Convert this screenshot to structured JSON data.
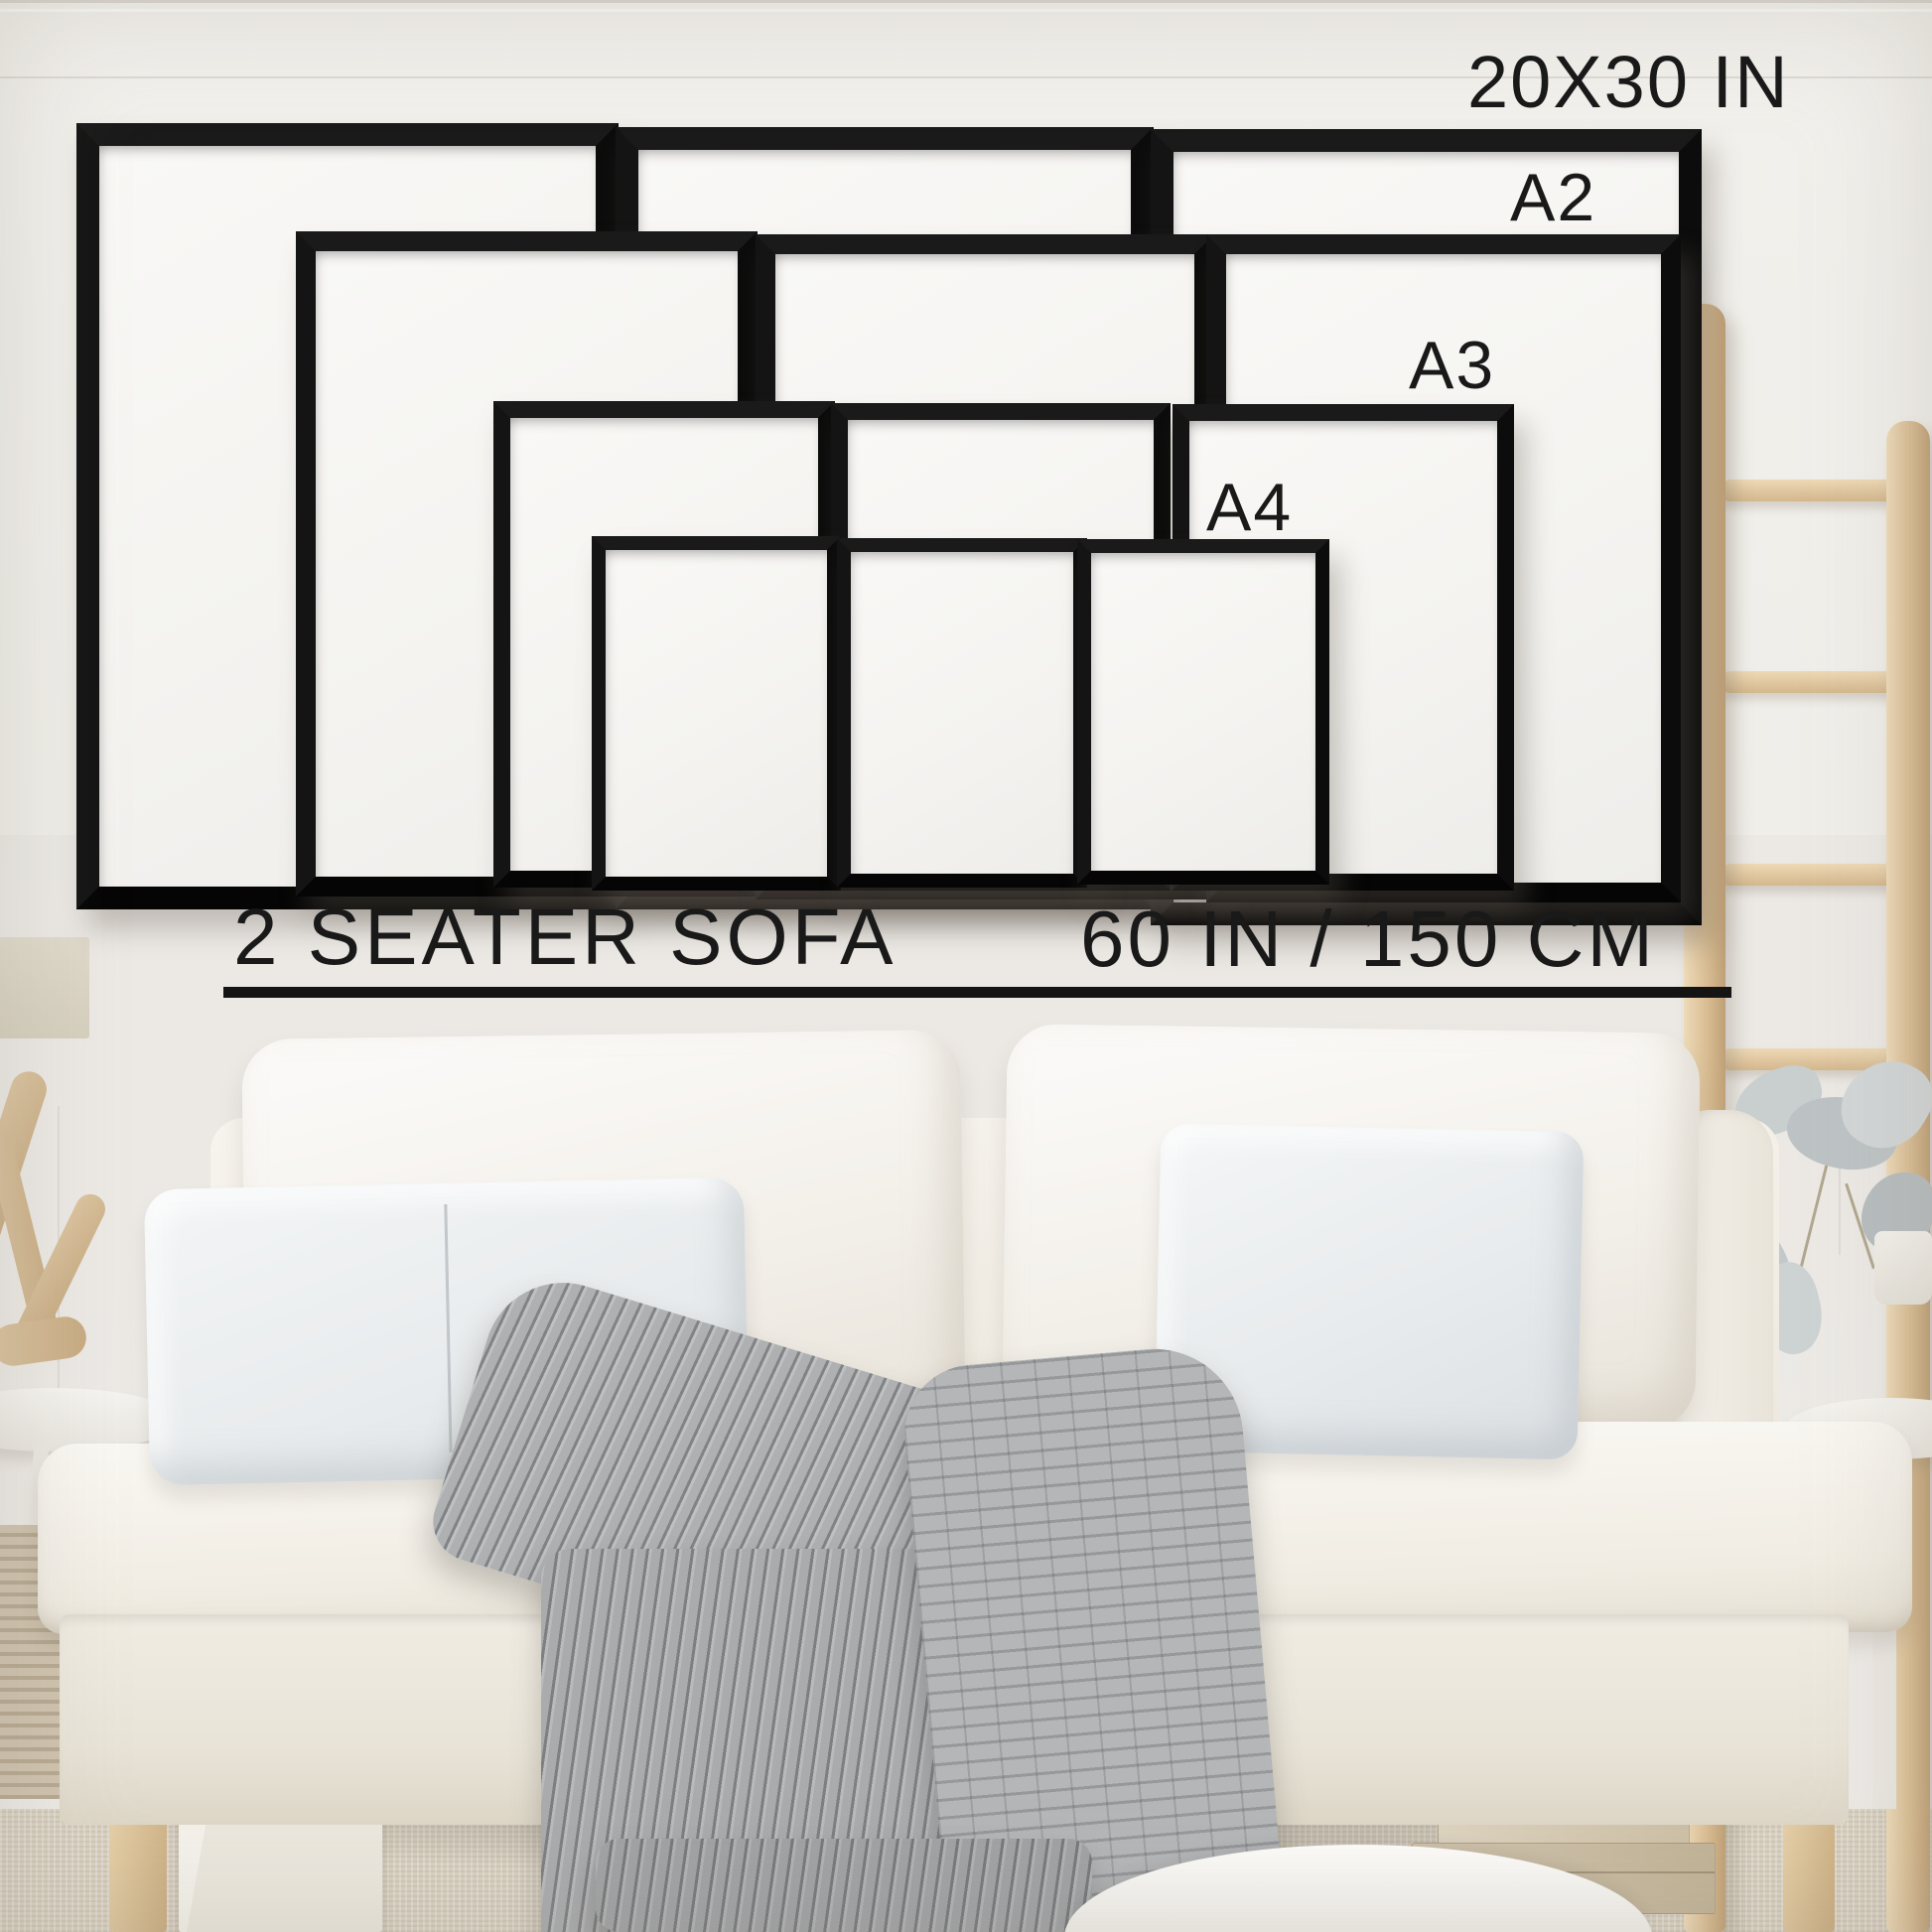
{
  "title": "Picture frame size guide above a 2 seater sofa",
  "overlay": {
    "size_labels": {
      "largest": "20X30 IN",
      "a2": "A2",
      "a3": "A3",
      "a4": "A4"
    },
    "sofa_label": "2 SEATER SOFA",
    "sofa_width_label": "60 IN / 150 CM"
  },
  "size_guide": {
    "frame_sizes": [
      {
        "name": "20X30 IN",
        "count": 3
      },
      {
        "name": "A2",
        "count": 3
      },
      {
        "name": "A3",
        "count": 3
      },
      {
        "name": "A4",
        "count": 3
      }
    ],
    "reference_object": "2 seater sofa",
    "reference_width_in": 60,
    "reference_width_cm": 150
  },
  "colors": {
    "wall": "#eae7e3",
    "wainscot": "#f2f0ec",
    "frame": "#0d0d0d",
    "frame_mat": "#f6f5f2",
    "text": "#191919",
    "sofa": "#f4f1ea",
    "pillow_grey": "#e8ebed",
    "blanket_grey": "#aeb0b2",
    "wood": "#d9c3a0",
    "carpet": "#d9d1c2"
  },
  "scene_objects": [
    "twelve black gallery wall frames",
    "white wall with wainscoting",
    "cream 2 seater sofa",
    "two white back cushions",
    "grey lumbar pillow",
    "grey throw pillow",
    "grey knitted throw blanket",
    "wooden blanket ladder",
    "eucalyptus stems in white vase",
    "round white side tables",
    "driftwood decor",
    "woven basket",
    "white storage box",
    "cardboard storage boxes",
    "white floor cushion",
    "beige carpet"
  ]
}
